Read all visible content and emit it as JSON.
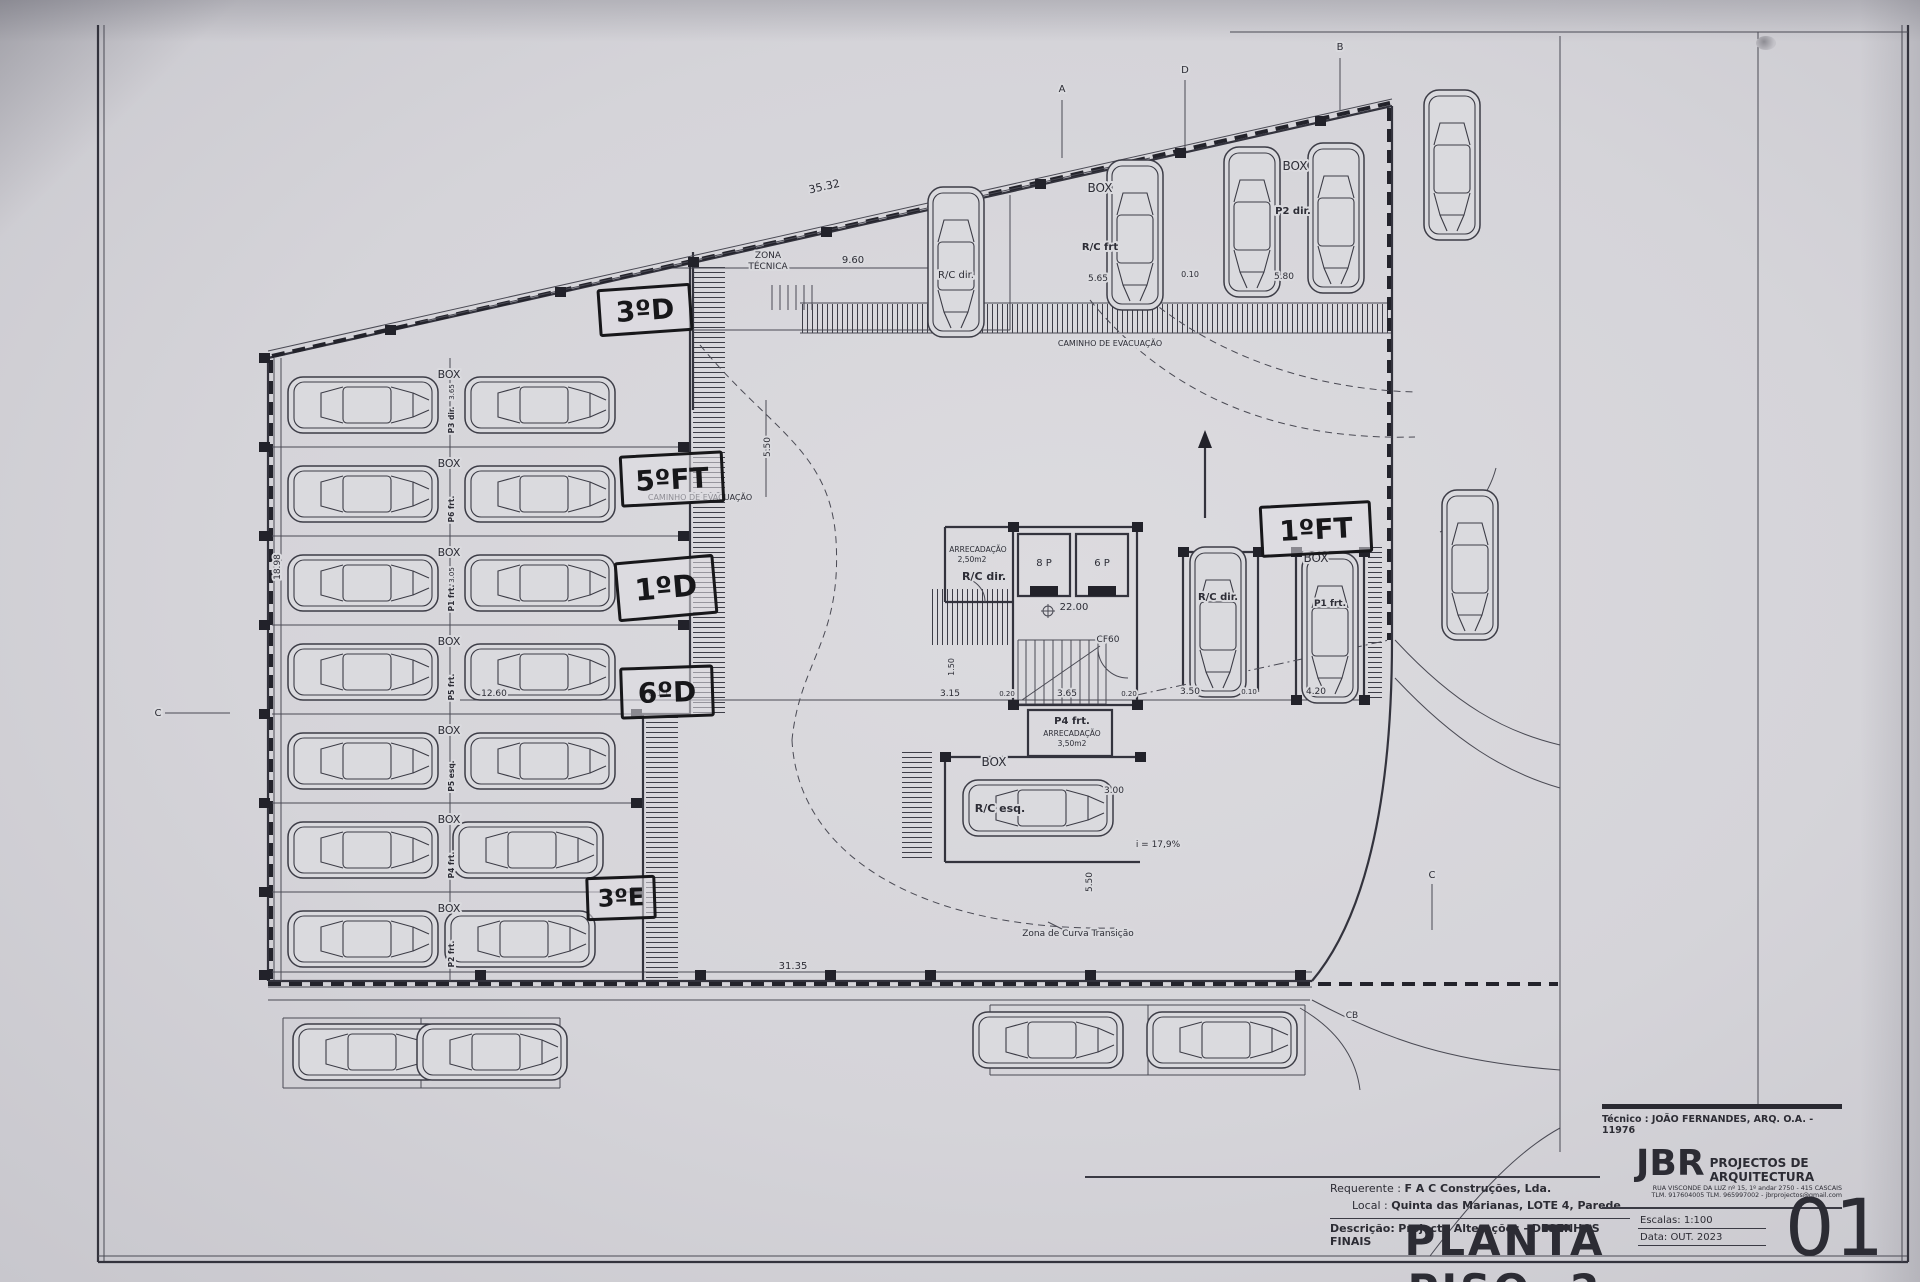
{
  "title_block": {
    "tecnico": "Técnico : JOÃO FERNANDES, ARQ.   O.A. - 11976",
    "firm_logo": "JBR",
    "firm_name": "PROJECTOS DE ARQUITECTURA",
    "firm_address": "RUA VISCONDE DA LUZ nº 15, 1º andar  2750 - 415 CASCAIS",
    "firm_contacts": "TLM. 917604005  TLM. 965997002 - jbrprojectos@gmail.com",
    "requerente_label": "Requerente :",
    "requerente_value": "F A C  Construções, Lda.",
    "local_label": "Local :",
    "local_value": "Quinta das Marianas, LOTE 4, Parede",
    "descricao_label": "Descrição:",
    "descricao_value": "Projecto Alterações - DESENHOS FINAIS",
    "drawing_title": "PLANTA PISO -2",
    "escala_label": "Escalas:",
    "escala_value": "1:100",
    "data_label": "Data:",
    "data_value": "OUT. 2023",
    "sheet_number": "01"
  },
  "handwritten_notes": [
    {
      "name": "note-3d",
      "text": "3ºD",
      "x": 598,
      "y": 286,
      "w": 88,
      "h": 42,
      "rot": -4,
      "fs": 28
    },
    {
      "name": "note-5ft",
      "text": "5ºFT",
      "x": 620,
      "y": 453,
      "w": 98,
      "h": 46,
      "rot": -3,
      "fs": 28
    },
    {
      "name": "note-1d",
      "text": "1ºD",
      "x": 616,
      "y": 558,
      "w": 94,
      "h": 54,
      "rot": -5,
      "fs": 30
    },
    {
      "name": "note-6d",
      "text": "6ºD",
      "x": 620,
      "y": 666,
      "w": 88,
      "h": 46,
      "rot": -2,
      "fs": 28
    },
    {
      "name": "note-3e",
      "text": "3ºE",
      "x": 586,
      "y": 876,
      "w": 64,
      "h": 38,
      "rot": -2,
      "fs": 24
    },
    {
      "name": "note-1ft",
      "text": "1ºFT",
      "x": 1260,
      "y": 503,
      "w": 106,
      "h": 46,
      "rot": -3,
      "fs": 28
    }
  ],
  "plan": {
    "parking_rows_left": [
      {
        "box_label": "BOX",
        "stall_label": "P3 dir."
      },
      {
        "box_label": "BOX",
        "stall_label": "P6 frt."
      },
      {
        "box_label": "BOX",
        "stall_label": "P1 frt."
      },
      {
        "box_label": "BOX",
        "stall_label": "P5 frt."
      },
      {
        "box_label": "BOX",
        "stall_label": "P5 esq."
      },
      {
        "box_label": "BOX",
        "stall_label": "P4 frt."
      },
      {
        "box_label": "BOX",
        "stall_label": "P2 frt."
      }
    ],
    "labels": [
      {
        "name": "dim-top-slope",
        "text": "35.32",
        "x": 825,
        "y": 190,
        "fs": 11,
        "rot": -12.7
      },
      {
        "name": "label-zona-tecnica-1",
        "text": "ZONA",
        "x": 768,
        "y": 258,
        "fs": 9
      },
      {
        "name": "label-zona-tecnica-2",
        "text": "TÉCNICA",
        "x": 768,
        "y": 269,
        "fs": 9
      },
      {
        "name": "dim-9-60",
        "text": "9.60",
        "x": 853,
        "y": 263,
        "fs": 10
      },
      {
        "name": "label-box-top-1",
        "text": "BOX",
        "x": 1100,
        "y": 192,
        "fs": 12
      },
      {
        "name": "label-rc-frt-top",
        "text": "R/C frt",
        "x": 1100,
        "y": 250,
        "fs": 10,
        "bold": true
      },
      {
        "name": "dim-5-65",
        "text": "5.65",
        "x": 1098,
        "y": 281,
        "fs": 9
      },
      {
        "name": "dim-0-10-top",
        "text": "0.10",
        "x": 1190,
        "y": 277,
        "fs": 8
      },
      {
        "name": "label-box-top-2",
        "text": "BOX",
        "x": 1295,
        "y": 170,
        "fs": 12
      },
      {
        "name": "label-p2-dir",
        "text": "P2 dir.",
        "x": 1293,
        "y": 214,
        "fs": 10,
        "bold": true
      },
      {
        "name": "dim-5-80",
        "text": "5.80",
        "x": 1284,
        "y": 279,
        "fs": 9
      },
      {
        "name": "label-rc-dir-top",
        "text": "R/C dir.",
        "x": 956,
        "y": 278,
        "fs": 10
      },
      {
        "name": "label-caminho-evacuacao-top",
        "text": "CAMINHO DE EVACUAÇÃO",
        "x": 1110,
        "y": 346,
        "fs": 8
      },
      {
        "name": "label-caminho-evacuacao-left",
        "text": "CAMINHO DE EVACUAÇÃO",
        "x": 700,
        "y": 500,
        "fs": 8
      },
      {
        "name": "dim-5-50-top",
        "text": "5.50",
        "x": 770,
        "y": 447,
        "fs": 9,
        "rot": -90
      },
      {
        "name": "label-level-22",
        "text": "22.00",
        "x": 1074,
        "y": 610,
        "fs": 10
      },
      {
        "name": "label-cf60",
        "text": "CF60",
        "x": 1108,
        "y": 642,
        "fs": 9
      },
      {
        "name": "label-elevator-8p",
        "text": "8 P",
        "x": 1044,
        "y": 566,
        "fs": 10
      },
      {
        "name": "label-elevator-6p",
        "text": "6 P",
        "x": 1102,
        "y": 566,
        "fs": 10
      },
      {
        "name": "label-arrecadacao-1a",
        "text": "ARRECADAÇÃO",
        "x": 978,
        "y": 552,
        "fs": 7.5
      },
      {
        "name": "label-arrecadacao-1b",
        "text": "2,50m2",
        "x": 972,
        "y": 562,
        "fs": 7.5
      },
      {
        "name": "label-rc-dir-core",
        "text": "R/C dir.",
        "x": 984,
        "y": 580,
        "fs": 11,
        "bold": true
      },
      {
        "name": "label-p4-frt",
        "text": "P4 frt.",
        "x": 1072,
        "y": 724,
        "fs": 10,
        "bold": true
      },
      {
        "name": "label-arrecadacao-2a",
        "text": "ARRECADAÇÃO",
        "x": 1072,
        "y": 736,
        "fs": 7.5
      },
      {
        "name": "label-arrecadacao-2b",
        "text": "3,50m2",
        "x": 1072,
        "y": 746,
        "fs": 7.5
      },
      {
        "name": "label-box-resq",
        "text": "BOX",
        "x": 994,
        "y": 766,
        "fs": 12
      },
      {
        "name": "label-rc-esq",
        "text": "R/C esq.",
        "x": 1000,
        "y": 812,
        "fs": 11,
        "bold": true
      },
      {
        "name": "label-box-right",
        "text": "BOX",
        "x": 1316,
        "y": 562,
        "fs": 12
      },
      {
        "name": "label-p1-frt",
        "text": "P1 frt.",
        "x": 1330,
        "y": 606,
        "fs": 9,
        "bold": true
      },
      {
        "name": "label-rc-dir-right",
        "text": "R/C dir.",
        "x": 1218,
        "y": 600,
        "fs": 10,
        "bold": true
      },
      {
        "name": "label-slope",
        "text": "i = 17,9%",
        "x": 1158,
        "y": 847,
        "fs": 9
      },
      {
        "name": "label-zona-curva",
        "text": "Zona de Curva Transição",
        "x": 1078,
        "y": 936,
        "fs": 9
      },
      {
        "name": "dim-31-35",
        "text": "31.35",
        "x": 793,
        "y": 969,
        "fs": 10
      },
      {
        "name": "dim-3-00",
        "text": "3.00",
        "x": 1114,
        "y": 793,
        "fs": 9
      },
      {
        "name": "dim-5-50-right",
        "text": "5.50",
        "x": 1092,
        "y": 882,
        "fs": 9,
        "rot": -90
      },
      {
        "name": "dim-1-50",
        "text": "1.50",
        "x": 954,
        "y": 667,
        "fs": 8,
        "rot": -90
      },
      {
        "name": "dim-18-98",
        "text": "18.98",
        "x": 280,
        "y": 567,
        "fs": 9,
        "rot": -90
      },
      {
        "name": "dim-12-60",
        "text": "12.60",
        "x": 494,
        "y": 696,
        "fs": 9
      },
      {
        "name": "dim-6-15",
        "text": "6.15",
        "x": 658,
        "y": 696,
        "fs": 9
      },
      {
        "name": "dim-3-15",
        "text": "3.15",
        "x": 950,
        "y": 696,
        "fs": 9
      },
      {
        "name": "dim-0-20-a",
        "text": "0.20",
        "x": 1007,
        "y": 696,
        "fs": 7
      },
      {
        "name": "dim-3-65",
        "text": "3.65",
        "x": 1067,
        "y": 696,
        "fs": 9
      },
      {
        "name": "dim-0-20-b",
        "text": "0.20",
        "x": 1129,
        "y": 696,
        "fs": 7
      },
      {
        "name": "dim-3-50",
        "text": "3.50",
        "x": 1190,
        "y": 694,
        "fs": 9
      },
      {
        "name": "dim-0-10-b",
        "text": "0.10",
        "x": 1249,
        "y": 694,
        "fs": 7
      },
      {
        "name": "dim-4-20",
        "text": "4.20",
        "x": 1316,
        "y": 694,
        "fs": 9
      },
      {
        "name": "dim-3-65-row1",
        "text": "3.65",
        "x": 454,
        "y": 392,
        "fs": 7,
        "rot": -90
      },
      {
        "name": "dim-3-05-row3",
        "text": "3.05",
        "x": 454,
        "y": 575,
        "fs": 7,
        "rot": -90
      },
      {
        "name": "axis-a",
        "text": "A",
        "x": 1062,
        "y": 92,
        "fs": 10
      },
      {
        "name": "axis-d",
        "text": "D",
        "x": 1185,
        "y": 73,
        "fs": 10
      },
      {
        "name": "axis-b",
        "text": "B",
        "x": 1340,
        "y": 50,
        "fs": 10
      },
      {
        "name": "axis-c-left",
        "text": "C",
        "x": 158,
        "y": 716,
        "fs": 10
      },
      {
        "name": "axis-c-right",
        "text": "C",
        "x": 1432,
        "y": 878,
        "fs": 10
      },
      {
        "name": "axis-cb",
        "text": "CB",
        "x": 1352,
        "y": 1018,
        "fs": 9
      }
    ]
  }
}
